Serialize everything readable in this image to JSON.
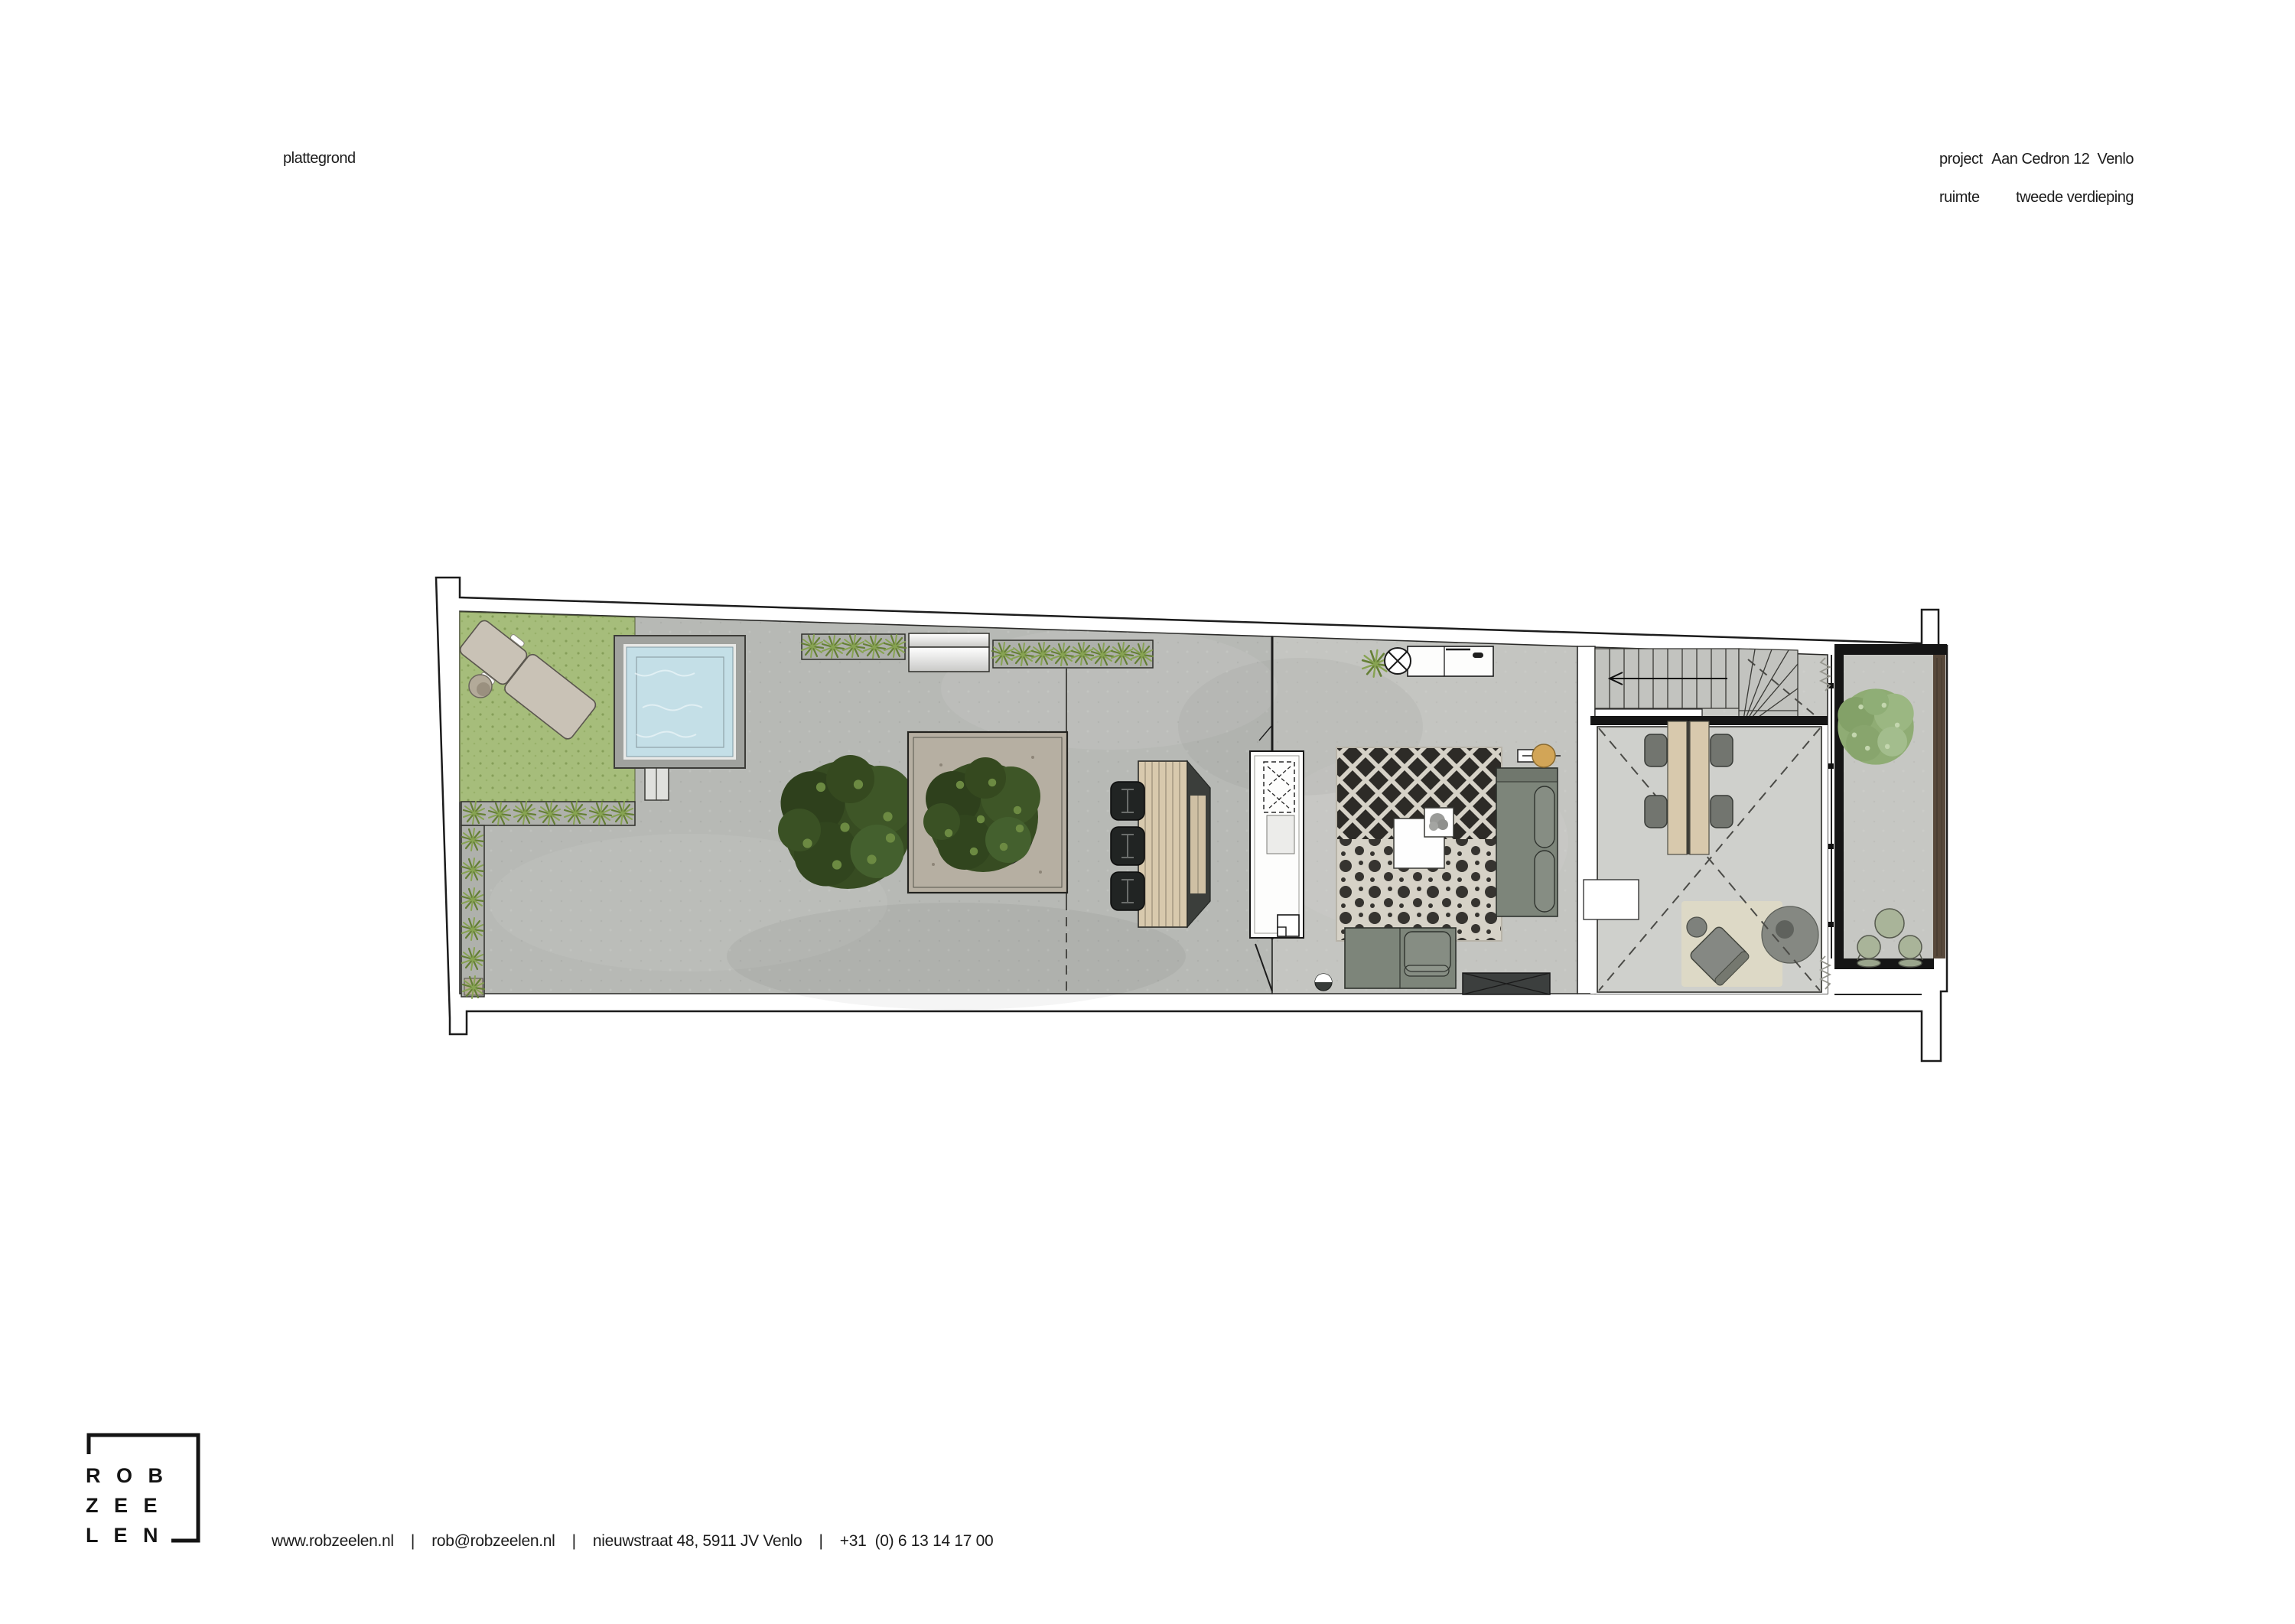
{
  "header": {
    "title": "plattegrond"
  },
  "project_info": {
    "project_label": "project",
    "project_value": "Aan Cedron 12  Venlo",
    "ruimte_label": "ruimte",
    "ruimte_value": "tweede verdieping"
  },
  "footer": {
    "contact_line": "www.robzeelen.nl    |    rob@robzeelen.nl    |    nieuwstraat 48, 5911 JV Venlo    |    +31  (0) 6 13 14 17 00",
    "logo_lines": [
      "R O B",
      "Z E E",
      "L E N"
    ]
  },
  "palette": {
    "ink": "#1c1c1c",
    "wall_line": "#2a2a28",
    "concrete_outdoor": "#b7b9b5",
    "concrete_indoor": "#c4c5c1",
    "concrete_hall": "#c9cac6",
    "concrete_vide": "#cfd0cc",
    "concrete_balcony": "#c6c7c3",
    "grass": "#a6bd7b",
    "water": "#c4dfe7",
    "pool_deck": "#a0a29e",
    "planter_stone": "#b6afa2",
    "wood_light": "#d8c9ad",
    "dark_bench": "#3b3e3b",
    "chair_black": "#212423",
    "sofa": "#7d857a",
    "chair_gray": "#72756f",
    "gold": "#d2a557",
    "balcony_green": "#a9b499",
    "wood_wall": "#57483a",
    "lounger": "#c9c2b6",
    "rug_base": "#d6d2c7",
    "rug_ink": "#1a1815",
    "beige_rug": "#ded9c6",
    "pouf_gray": "#858882"
  }
}
